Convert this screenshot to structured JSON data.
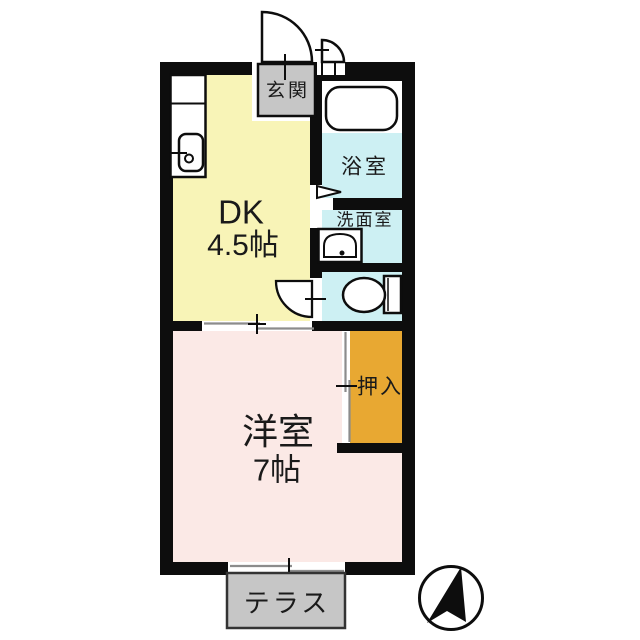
{
  "title": "1DK間取り図",
  "rooms": {
    "dk": {
      "name": "DK",
      "size": "4.5帖"
    },
    "entrance": {
      "name": "玄関"
    },
    "bath": {
      "name": "浴室"
    },
    "washroom": {
      "name": "洗面室"
    },
    "western": {
      "name": "洋室",
      "size": "7帖"
    },
    "closet": {
      "name": "押入"
    },
    "terrace": {
      "name": "テラス"
    }
  },
  "icons": {
    "compass": "north-arrow",
    "fixtures": [
      "kitchen-sink",
      "bathtub",
      "washbasin",
      "toilet"
    ],
    "doors": [
      "entrance-swing-door",
      "small-swing-door",
      "bath-folding-door",
      "toilet-swing-door",
      "sliding-door",
      "sliding-window",
      "closet-sliding-door"
    ]
  },
  "colors": {
    "c-wall": "#0d0d0d",
    "c-dk": "#f8f4b7",
    "c-wet": "#cdf0f3",
    "c-western": "#fbe9e6",
    "c-closet": "#e8a832",
    "c-gray": "#c6c6c6",
    "c-line": "#8c8c8c",
    "c-text": "#1a1a1a"
  }
}
